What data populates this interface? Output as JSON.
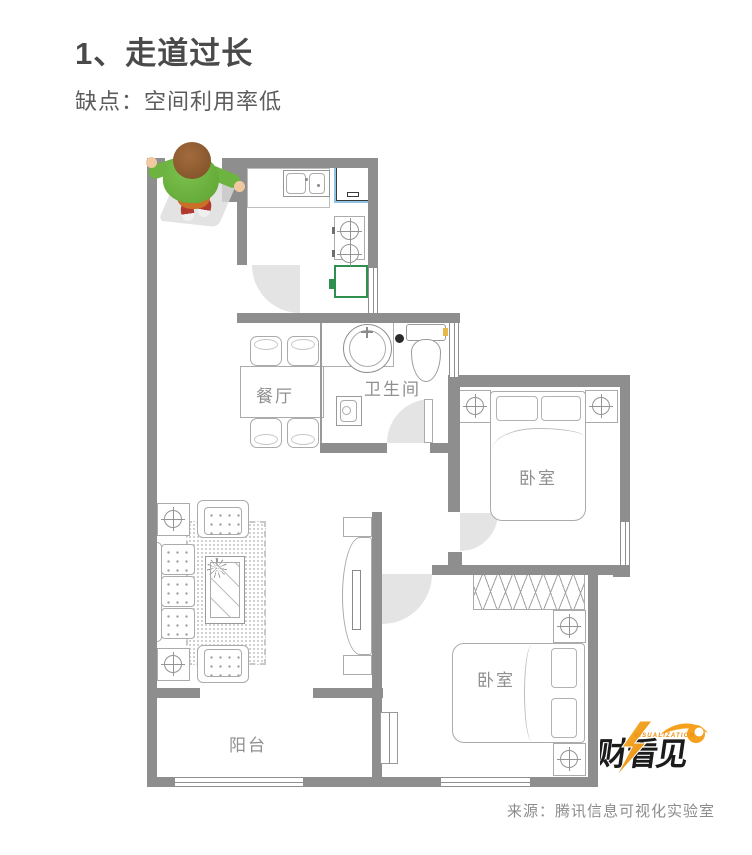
{
  "page": {
    "title": "1、走道过长",
    "subtitle": "缺点：空间利用率低",
    "source": "来源：腾讯信息可视化实验室"
  },
  "floorplan": {
    "rooms": [
      {
        "id": "dining",
        "label": "餐厅"
      },
      {
        "id": "bathroom",
        "label": "卫生间"
      },
      {
        "id": "bedroom-top",
        "label": "卧室"
      },
      {
        "id": "bedroom-bottom",
        "label": "卧室"
      },
      {
        "id": "balcony",
        "label": "阳台"
      }
    ],
    "colors": {
      "wall": "#8E8E8E",
      "furniture_line": "#ABABAB",
      "door_swing": "#E4E4E4",
      "cabinet_green": "#2F8F4E",
      "fridge_blue": "#8EC3E6",
      "toilet_button_yellow": "#E8B84B",
      "boy_shirt_green": "#6DB33F",
      "boy_pants_orange": "#C96F28",
      "boy_shoes_red": "#B03A2E"
    }
  },
  "logo": {
    "text": "财看见",
    "tagline": "VISUALIZATION",
    "accent": "#F5A11D",
    "dark": "#1B1B1B"
  }
}
